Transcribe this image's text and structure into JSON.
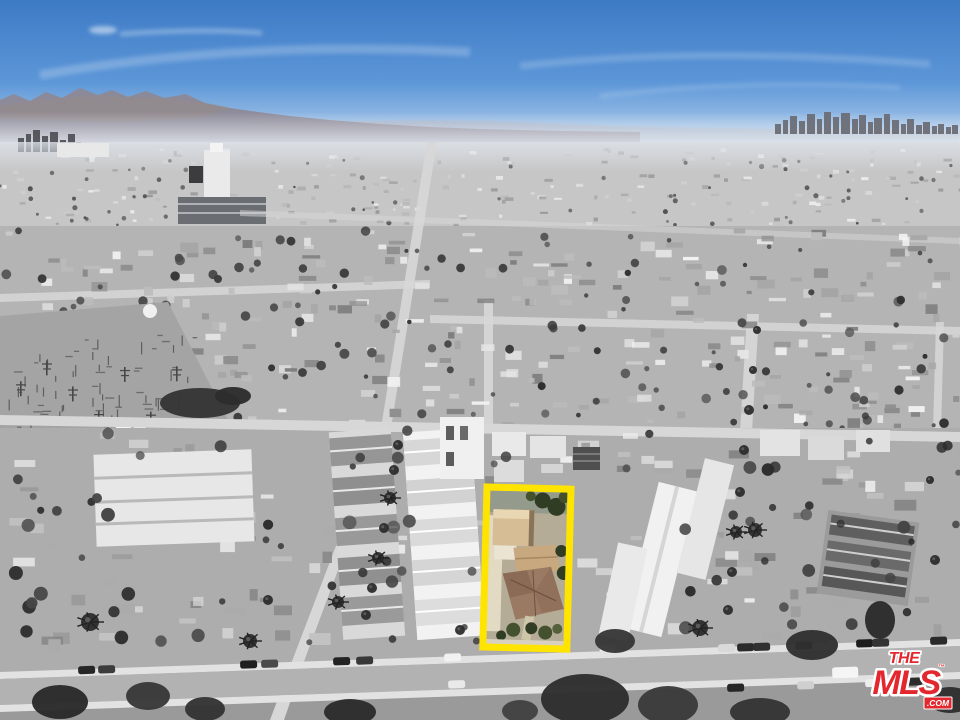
{
  "logo": {
    "the": "THE",
    "mls": "MLS",
    "tm": "™",
    "com": ".COM"
  },
  "colors": {
    "sky_top": "#3d7ac5",
    "sky_mid": "#5d97d8",
    "sky_horizon": "#c3d8ee",
    "mountain_near": "#8e8894",
    "mountain_far": "#a9aebc",
    "mountain_brown": "#9a8a7e",
    "city_far": "#c6c6c6",
    "city_mid": "#b4b4b4",
    "city_low": "#adadad",
    "road": "#d7d7d7",
    "sidewalk": "#e2e2e2",
    "downtown": "#6b6e76",
    "white_roof": "#efefef",
    "tree_dark": "#343434",
    "highlight_yellow": "#ffe400",
    "prop_ground": "#b5ac97",
    "prop_driveway": "#e3dac4",
    "prop_tan": "#d6bd96",
    "prop_tan_light": "#e9d7b3",
    "prop_roof": "#9b7a64",
    "prop_roof_dark": "#7d5d4b",
    "prop_green": "#44512f",
    "prop_green_dark": "#313c24",
    "logo_red": "#e2282e",
    "logo_white": "#ffffff"
  },
  "highlight": {
    "x": 487,
    "y": 487,
    "width": 84,
    "height": 160,
    "rotation_deg": 1.5,
    "border_width": 7
  },
  "scene": {
    "seed": 11,
    "scatter": [
      {
        "layer": "scatter-far",
        "x": 0,
        "y": 148,
        "w": 960,
        "h": 76,
        "count": 210,
        "minW": 3,
        "maxW": 9,
        "minH": 2,
        "maxH": 4,
        "palette": [
          "#a8a8a8",
          "#b9b9b9",
          "#cfcfcf",
          "#dedede",
          "#eaeaea",
          "#999999"
        ]
      },
      {
        "layer": "scatter-mid",
        "x": 0,
        "y": 226,
        "w": 960,
        "h": 200,
        "count": 270,
        "minW": 5,
        "maxW": 18,
        "minH": 3,
        "maxH": 10,
        "palette": [
          "#8f8f8f",
          "#a5a5a5",
          "#bcbcbc",
          "#d0d0d0",
          "#e6e6e6",
          "#f2f2f2",
          "#7e7e7e"
        ]
      },
      {
        "layer": "scatter-low",
        "x": 0,
        "y": 430,
        "w": 960,
        "h": 215,
        "count": 150,
        "minW": 7,
        "maxW": 22,
        "minH": 4,
        "maxH": 12,
        "palette": [
          "#9a9a9a",
          "#ababab",
          "#c2c2c2",
          "#d8d8d8",
          "#ececec",
          "#868686"
        ]
      }
    ],
    "trees": [
      {
        "layer": "trees-far",
        "x": 0,
        "y": 160,
        "w": 960,
        "h": 66,
        "count": 70,
        "minR": 1.2,
        "maxR": 2.6,
        "palette": [
          "#5c5c5c",
          "#6a6a6a",
          "#4e4e4e"
        ]
      },
      {
        "layer": "trees-mid",
        "x": 0,
        "y": 230,
        "w": 960,
        "h": 198,
        "count": 130,
        "minR": 2,
        "maxR": 5,
        "palette": [
          "#3a3a3a",
          "#2f2f2f",
          "#4a4a4a",
          "#565656"
        ]
      },
      {
        "layer": "trees-low",
        "x": 0,
        "y": 428,
        "w": 960,
        "h": 215,
        "count": 80,
        "minR": 3,
        "maxR": 7,
        "palette": [
          "#333333",
          "#2b2b2b",
          "#454545",
          "#515151"
        ]
      }
    ],
    "downtown": {
      "baseline": 134,
      "fill": "#6b6e76",
      "towers": [
        [
          775,
          6,
          10
        ],
        [
          783,
          5,
          14
        ],
        [
          790,
          7,
          18
        ],
        [
          799,
          6,
          13
        ],
        [
          807,
          8,
          20
        ],
        [
          817,
          5,
          15
        ],
        [
          824,
          7,
          22
        ],
        [
          833,
          6,
          17
        ],
        [
          841,
          9,
          21
        ],
        [
          852,
          6,
          15
        ],
        [
          859,
          7,
          19
        ],
        [
          868,
          5,
          12
        ],
        [
          874,
          8,
          16
        ],
        [
          884,
          6,
          20
        ],
        [
          892,
          7,
          14
        ],
        [
          901,
          5,
          10
        ],
        [
          907,
          7,
          15
        ],
        [
          916,
          6,
          9
        ],
        [
          923,
          7,
          12
        ],
        [
          932,
          5,
          8
        ],
        [
          938,
          6,
          10
        ],
        [
          946,
          5,
          7
        ],
        [
          952,
          6,
          9
        ]
      ]
    },
    "left_towers": {
      "baseline": 152,
      "fill": "#4a4c52",
      "towers": [
        [
          18,
          6,
          14
        ],
        [
          26,
          5,
          18
        ],
        [
          33,
          7,
          22
        ],
        [
          42,
          6,
          16
        ],
        [
          50,
          8,
          20
        ],
        [
          60,
          6,
          12
        ],
        [
          68,
          7,
          18
        ],
        [
          76,
          5,
          10
        ]
      ]
    },
    "substation": {
      "x": 8,
      "y": 334,
      "w": 192,
      "h": 122,
      "count": 95,
      "tick_color": "#5f5f5f",
      "bar_color": "#6c6c6c",
      "mast_color": "#474747"
    },
    "palms": [
      [
        398,
        445,
        5
      ],
      [
        394,
        470,
        5
      ],
      [
        390,
        498,
        6
      ],
      [
        384,
        528,
        5
      ],
      [
        378,
        558,
        6
      ],
      [
        372,
        588,
        5
      ],
      [
        366,
        615,
        5
      ],
      [
        757,
        330,
        4
      ],
      [
        753,
        370,
        4
      ],
      [
        749,
        410,
        5
      ],
      [
        744,
        450,
        5
      ],
      [
        740,
        492,
        5
      ],
      [
        736,
        532,
        6
      ],
      [
        732,
        572,
        5
      ],
      [
        728,
        610,
        5
      ],
      [
        90,
        622,
        9
      ],
      [
        250,
        641,
        7
      ],
      [
        700,
        628,
        8
      ],
      [
        755,
        530,
        7
      ],
      [
        338,
        602,
        6
      ],
      [
        520,
        640,
        5
      ],
      [
        268,
        600,
        5
      ],
      [
        460,
        630,
        5
      ],
      [
        935,
        560,
        5
      ],
      [
        930,
        480,
        4
      ]
    ],
    "cars": {
      "street": {
        "y0": 679,
        "slope": 0.0344,
        "lane_up": -10,
        "lane_mid": 17,
        "lane_low": 30
      },
      "list": [
        {
          "x": 78,
          "lane": "up",
          "c": "#262626"
        },
        {
          "x": 98,
          "lane": "up",
          "c": "#3c3c3c"
        },
        {
          "x": 240,
          "lane": "up",
          "c": "#1f1f1f"
        },
        {
          "x": 261,
          "lane": "up",
          "c": "#4a4a4a"
        },
        {
          "x": 333,
          "lane": "up",
          "c": "#232323"
        },
        {
          "x": 356,
          "lane": "up",
          "c": "#383838"
        },
        {
          "x": 444,
          "lane": "up",
          "c": "#f2f2f2"
        },
        {
          "x": 718,
          "lane": "up",
          "c": "#d9d9d9"
        },
        {
          "x": 737,
          "lane": "up",
          "c": "#2a2a2a"
        },
        {
          "x": 753,
          "lane": "up",
          "c": "#303030"
        },
        {
          "x": 795,
          "lane": "up",
          "c": "#242424"
        },
        {
          "x": 856,
          "lane": "up",
          "c": "#1d1d1d"
        },
        {
          "x": 872,
          "lane": "up",
          "c": "#343434"
        },
        {
          "x": 930,
          "lane": "up",
          "c": "#2a2a2a"
        },
        {
          "x": 448,
          "lane": "mid",
          "c": "#e9e9e9"
        },
        {
          "x": 832,
          "lane": "mid",
          "c": "#f5f5f5",
          "van": true
        },
        {
          "x": 727,
          "lane": "low",
          "c": "#262626"
        },
        {
          "x": 797,
          "lane": "low",
          "c": "#cfcfcf"
        },
        {
          "x": 865,
          "lane": "low",
          "c": "#ededed"
        },
        {
          "x": 905,
          "lane": "low",
          "c": "#2c2c2c"
        }
      ]
    },
    "big_trees": [
      [
        585,
        699,
        44,
        25,
        "#2e2e2e"
      ],
      [
        668,
        705,
        30,
        19,
        "#3a3a3a"
      ],
      [
        60,
        702,
        28,
        17,
        "#2a2a2a"
      ],
      [
        148,
        696,
        22,
        14,
        "#383838"
      ],
      [
        812,
        645,
        26,
        15,
        "#303030"
      ],
      [
        880,
        620,
        15,
        19,
        "#2b2b2b"
      ],
      [
        520,
        711,
        18,
        11,
        "#424242"
      ],
      [
        205,
        709,
        20,
        12,
        "#333333"
      ],
      [
        950,
        700,
        22,
        13,
        "#2f2f2f"
      ],
      [
        615,
        641,
        20,
        12,
        "#363636"
      ],
      [
        350,
        712,
        26,
        13,
        "#2c2c2c"
      ],
      [
        760,
        712,
        30,
        14,
        "#343434"
      ],
      [
        200,
        403,
        40,
        15,
        "#343434"
      ],
      [
        233,
        396,
        18,
        9,
        "#2d2d2d"
      ]
    ]
  }
}
